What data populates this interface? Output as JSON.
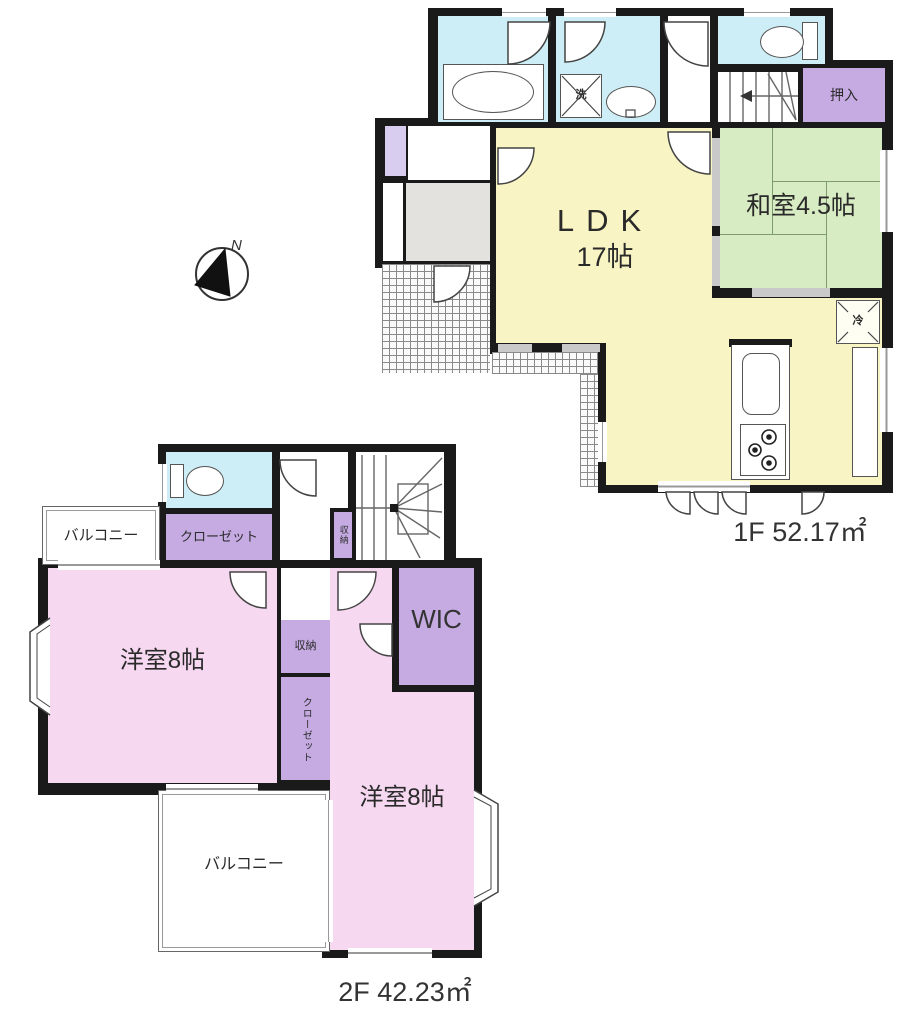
{
  "colors": {
    "wall": "#1a1a1a",
    "bath": "#cdeef6",
    "ldk": "#f9f4c3",
    "tatami": "#d8ecc3",
    "closet": "#c5abe2",
    "closetLight": "#d9cdef",
    "pink": "#f6d8f1",
    "genkan": "#e4e2de",
    "line": "#444444"
  },
  "compass": {
    "north_label": "N"
  },
  "floor1": {
    "area_label": "1F  52.17㎡",
    "ldk_label": "LDK",
    "ldk_size": "17帖",
    "tatami_room": "和室4.5帖",
    "oshiire": "押入",
    "laundry": "洗",
    "fridge": "冷"
  },
  "floor2": {
    "area_label": "2F  42.23㎡",
    "bedroom1": "洋室8帖",
    "bedroom2": "洋室8帖",
    "wic": "WIC",
    "closet_upper": "クローゼット",
    "closet_vertical": "クローゼット",
    "storage_stair": "収納",
    "storage_middle": "収納",
    "balcony_upper": "バルコニー",
    "balcony_lower": "バルコニー"
  }
}
